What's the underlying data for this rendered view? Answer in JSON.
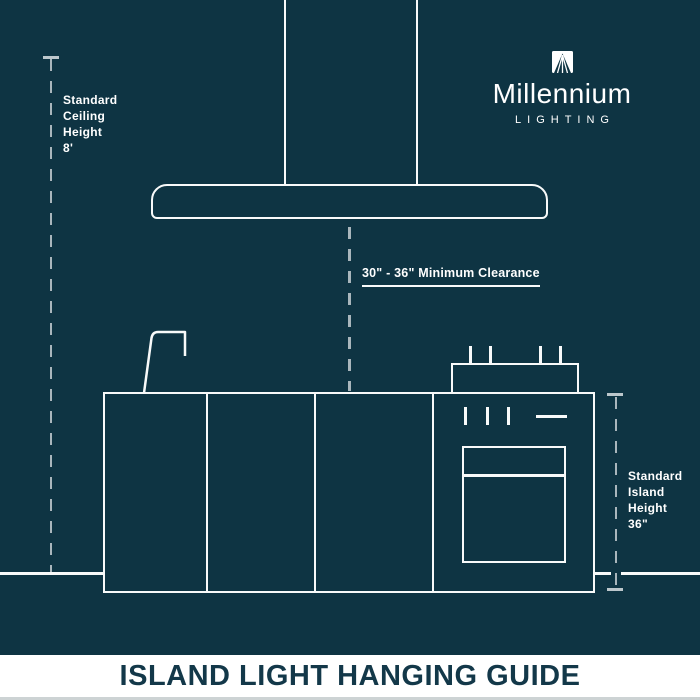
{
  "colors": {
    "background": "#0e3443",
    "line_white": "#f8fafa",
    "dash_gray": "#a9b6bc",
    "footer_background": "#ffffff",
    "footer_text": "#133849"
  },
  "brand": {
    "name": "Millennium",
    "tagline": "LIGHTING"
  },
  "annotations": {
    "ceiling_height": {
      "lines": [
        "Standard",
        "Ceiling",
        "Height",
        "8'"
      ]
    },
    "clearance": {
      "label": "30\" - 36\" Minimum Clearance"
    },
    "island_height": {
      "lines": [
        "Standard",
        "Island",
        "Height",
        "36\""
      ]
    }
  },
  "footer": {
    "title": "ISLAND LIGHT HANGING GUIDE"
  }
}
